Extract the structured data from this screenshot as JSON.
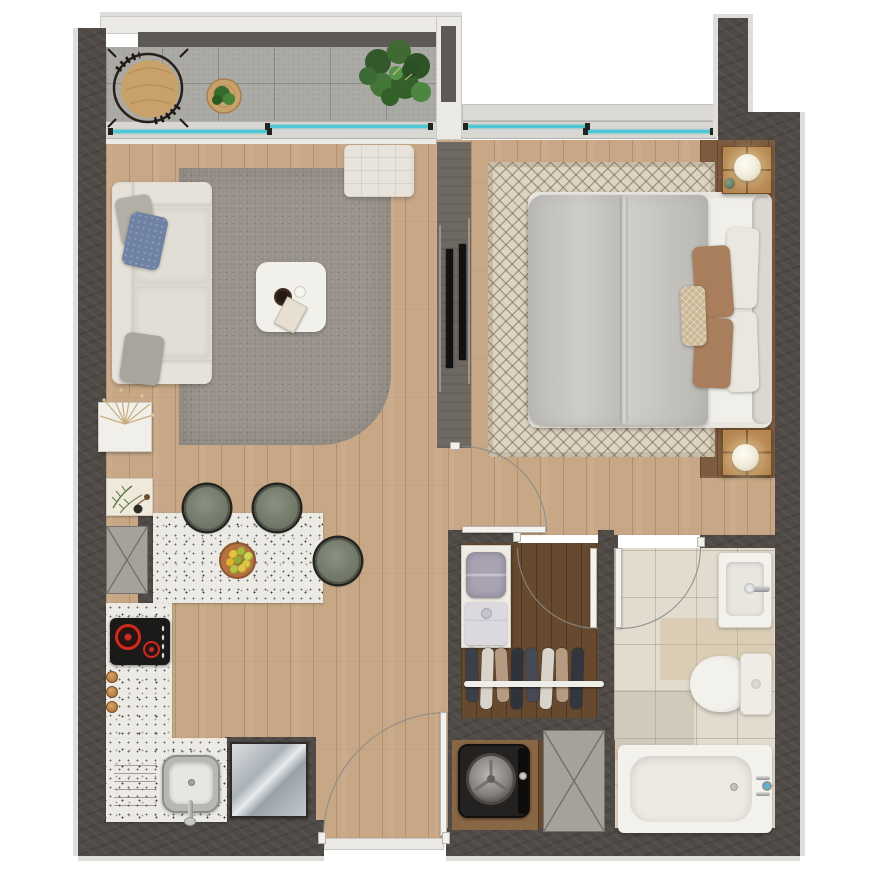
{
  "palette": {
    "background": "#ffffff",
    "wall": "#4f4a45",
    "wall_outline": "#dfdedb",
    "partition": "#6e6862",
    "wood_floor": "#c7a785",
    "wood_floor_dark": "#7d5b3e",
    "closet_floor": "#66492f",
    "balcony_floor": "#abaaa5",
    "bathroom_tile": "#e2dbce",
    "counter_terrazzo": "#eceae5",
    "rug_gray": "#98928a",
    "rug_pattern_base": "#ddd3c2",
    "glass": "#4cc8d6",
    "frame_light": "#d9d7d3",
    "sofa": "#dcd8cf",
    "duvet": "#c9c7c2",
    "pillow_rust": "#a87e5c",
    "pillow_blue": "#6f82a4",
    "stool": "#6f7565",
    "steel": "#b9c0c5",
    "lamp": "#f0ead8",
    "wood_furniture": "#b5854f",
    "tub": "#f3f1ec",
    "door_leaf": "#f4f2ed",
    "arc": "#8b8b89",
    "tv": "#121212",
    "washer": "#242220",
    "appliance_gray": "#a5a29c",
    "cooktop": "#1b1a19",
    "burner_red": "#cf2b20"
  },
  "windows": {
    "glass_color": "#4cc8d6",
    "balcony_slider_panes": 2,
    "bedroom_window_panes": 2
  },
  "doors": {
    "swing_doors": [
      "entrance-door",
      "bedroom-door",
      "closet-door",
      "bathroom-door"
    ]
  },
  "rooms": {
    "balcony": {
      "items": [
        "papasan-chair",
        "rattan-side-table",
        "potted-plant-small",
        "potted-plant-large"
      ]
    },
    "living_room": {
      "items": [
        "sofa",
        "gray-pillow",
        "blue-pillow",
        "area-rug",
        "coffee-table",
        "bowl",
        "cup",
        "book",
        "ottoman",
        "dried-plant"
      ]
    },
    "media_wall": {
      "items": [
        "tv-living-side",
        "tv-bedroom-side"
      ],
      "tv_count": 2
    },
    "bedroom": {
      "items": [
        "double-bed",
        "duvet",
        "headboard",
        "patterned-rug",
        "nightstand",
        "sphere-lamp"
      ],
      "nightstands": 2,
      "lamps": 2,
      "white_pillows": 2,
      "rust_pillows": 2,
      "lumbar_pillows": 1
    },
    "kitchen": {
      "items": [
        "bar-counter",
        "fruit-plate",
        "bar-stool",
        "cooktop",
        "kitchen-sink",
        "refrigerator",
        "wall-art-fern",
        "utility-box",
        "spice-jars",
        "drainboard"
      ],
      "bar_stools": 3,
      "spice_jars": 3,
      "burners": 2,
      "fruit_colors": [
        "#e6c33c",
        "#a9b93f",
        "#ccd84f",
        "#dfb32e",
        "#93a936",
        "#d9c93f",
        "#b5c446",
        "#e2c548"
      ]
    },
    "closet": {
      "items": [
        "shelf-unit",
        "storage-bag",
        "folded-shirt",
        "clothes-rail",
        "hanging-garments"
      ],
      "garment_colors": [
        "#3a3f4a",
        "#d8d4cc",
        "#b59b82",
        "#2f333b",
        "#454a56",
        "#d8d4cc",
        "#b59b82",
        "#33363e"
      ]
    },
    "laundry": {
      "items": [
        "washing-machine",
        "utility-cabinet"
      ]
    },
    "bathroom": {
      "items": [
        "washbasin",
        "toilet",
        "bathtub",
        "faucet"
      ]
    }
  }
}
